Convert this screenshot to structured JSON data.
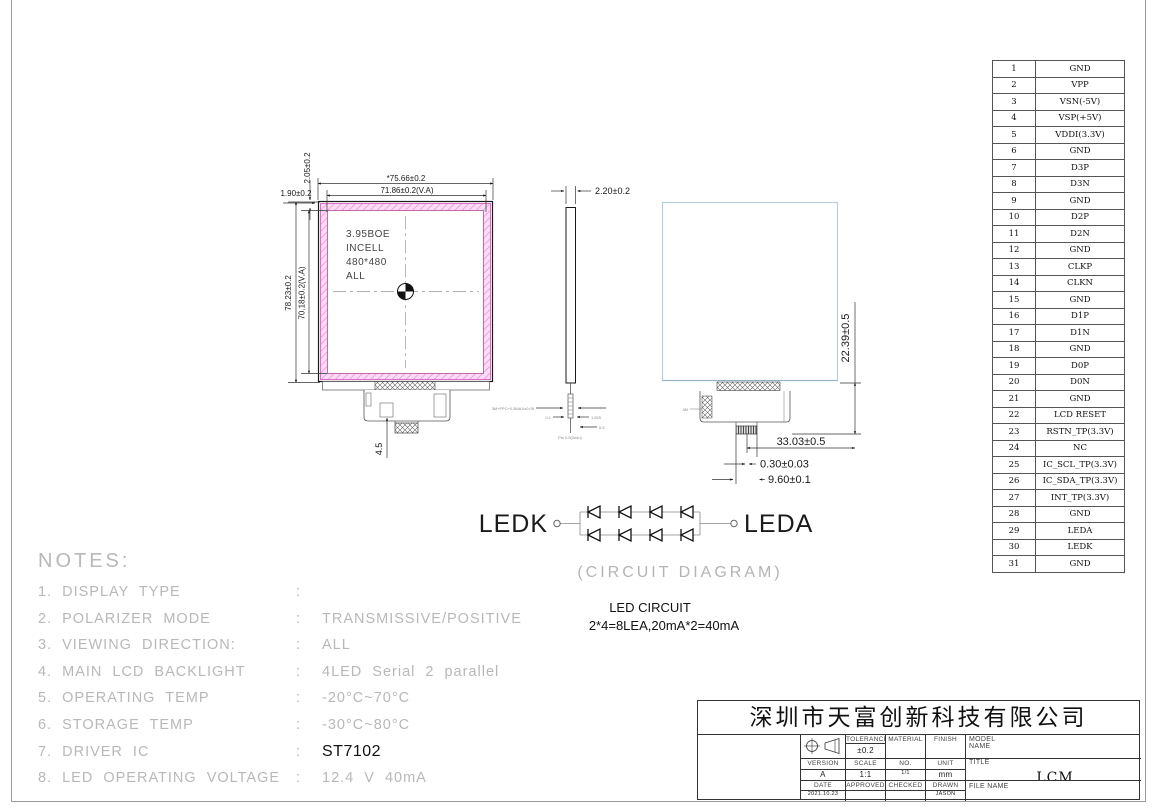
{
  "sheet": {
    "company": "深圳市天富创新科技有限公司",
    "title_block": {
      "tolerance_label": "TOLERANCE",
      "tolerance": "±0.2",
      "material_label": "MATERIAL",
      "finish_label": "FINISH",
      "model_name_label": "MODEL NAME",
      "version_label": "VERSION",
      "scale_label": "SCALE",
      "no_label": "NO.",
      "unit_label": "UNIT",
      "title_label": "TITLE",
      "version": "A",
      "scale": "1:1",
      "no": "1/1",
      "unit": "mm",
      "title": "LCM",
      "date_label": "DATE",
      "approved_label": "APPROVED",
      "checked_label": "CHECKED",
      "drawn_label": "DRAWN",
      "date": "2021.10.23",
      "drawn": "JASON",
      "file_name_label": "FILE NAME"
    }
  },
  "pin_table": {
    "rows": [
      [
        "1",
        "GND"
      ],
      [
        "2",
        "VPP"
      ],
      [
        "3",
        "VSN(-5V)"
      ],
      [
        "4",
        "VSP(+5V)"
      ],
      [
        "5",
        "VDDI(3.3V)"
      ],
      [
        "6",
        "GND"
      ],
      [
        "7",
        "D3P"
      ],
      [
        "8",
        "D3N"
      ],
      [
        "9",
        "GND"
      ],
      [
        "10",
        "D2P"
      ],
      [
        "11",
        "D2N"
      ],
      [
        "12",
        "GND"
      ],
      [
        "13",
        "CLKP"
      ],
      [
        "14",
        "CLKN"
      ],
      [
        "15",
        "GND"
      ],
      [
        "16",
        "D1P"
      ],
      [
        "17",
        "D1N"
      ],
      [
        "18",
        "GND"
      ],
      [
        "19",
        "D0P"
      ],
      [
        "20",
        "D0N"
      ],
      [
        "21",
        "GND"
      ],
      [
        "22",
        "LCD RESET"
      ],
      [
        "23",
        "RSTN_TP(3.3V)"
      ],
      [
        "24",
        "NC"
      ],
      [
        "25",
        "IC_SCL_TP(3.3V)"
      ],
      [
        "26",
        "IC_SDA_TP(3.3V)"
      ],
      [
        "27",
        "INT_TP(3.3V)"
      ],
      [
        "28",
        "GND"
      ],
      [
        "29",
        "LEDA"
      ],
      [
        "30",
        "LEDK"
      ],
      [
        "31",
        "GND"
      ]
    ]
  },
  "front_view": {
    "panel_label_lines": [
      "3.95BOE",
      "INCELL",
      "480*480",
      "ALL"
    ],
    "dims": {
      "width_outer": "*75.66±0.2",
      "width_va": "71.86±0.2(V.A)",
      "height_outer": "78.23±0.2",
      "height_va": "70.18±0.2(V.A)",
      "top_ledge": "2.05±0.2",
      "left_ledge": "1.90±0.2",
      "fpc_drop": "4.5"
    }
  },
  "side_view": {
    "dims": {
      "thickness": "2.20±0.2"
    },
    "micro": {
      "m1": "3M+FPC+0.3MAX±0.05",
      "m2": "0.1",
      "m3": "1.825",
      "m4": "0.5",
      "m5": "Pin 0.5(2min)"
    }
  },
  "rear_view": {
    "dims": {
      "fpc_height": "22.39±0.5",
      "fpc_length": "33.03±0.5",
      "connector_thickness": "0.30±0.03",
      "connector_width": "9.60±0.1"
    },
    "micro": {
      "m1": "3M"
    }
  },
  "led_circuit": {
    "ledk_label": "LEDK",
    "leda_label": "LEDA",
    "caption": "(CIRCUIT DIAGRAM)",
    "heading": "LED CIRCUIT",
    "formula": "2*4=8LEA,20mA*2=40mA"
  },
  "notes": {
    "title": "NOTES:",
    "items": [
      {
        "num": "1.",
        "label": "DISPLAY TYPE",
        "value": "",
        "em": false
      },
      {
        "num": "2.",
        "label": "POLARIZER MODE",
        "value": "TRANSMISSIVE/POSITIVE",
        "em": false
      },
      {
        "num": "3.",
        "label": "VIEWING DIRECTION:",
        "value": "ALL",
        "em": false
      },
      {
        "num": "4.",
        "label": "MAIN LCD BACKLIGHT",
        "value": "4LED Serial 2 parallel",
        "em": false
      },
      {
        "num": "5.",
        "label": "OPERATING TEMP",
        "value": "-20°C~70°C",
        "em": false
      },
      {
        "num": "6.",
        "label": "STORAGE TEMP",
        "value": "-30°C~80°C",
        "em": false
      },
      {
        "num": "7.",
        "label": "DRIVER IC",
        "value": "ST7102",
        "em": true
      },
      {
        "num": "8.",
        "label": "LED OPERATING VOLTAGE",
        "value": "12.4 V 40mA",
        "em": false
      }
    ]
  }
}
